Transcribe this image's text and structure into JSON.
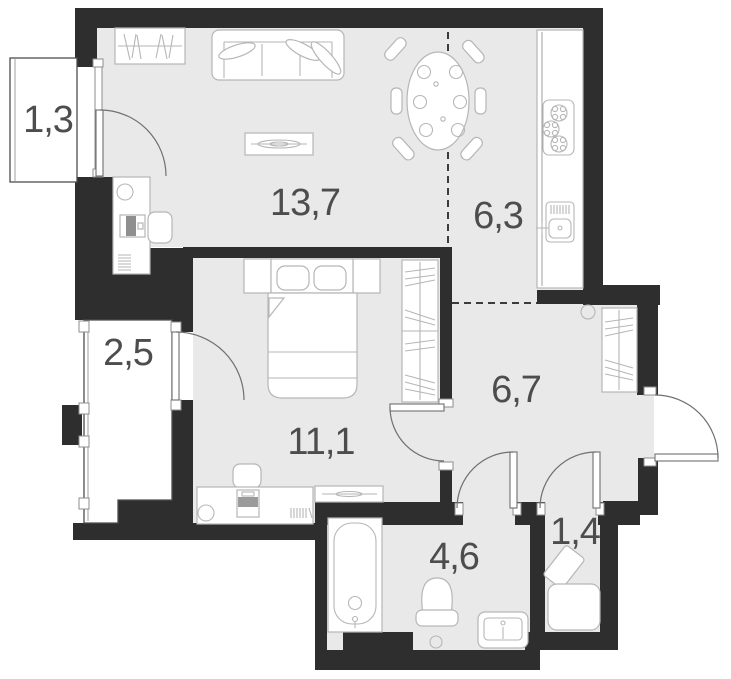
{
  "plan": {
    "type": "apartment-floor-plan",
    "colors": {
      "wall": "#2e2e2e",
      "floor": "#e9e9e9",
      "balcony_floor": "#ffffff",
      "furniture_stroke": "#b6b6b6",
      "label": "#4d4d4d",
      "door_arc": "#707070",
      "zone_dash": "#3c3c3c"
    },
    "rooms": [
      {
        "id": "balcony-top",
        "area": "1,3",
        "furniture": []
      },
      {
        "id": "living-room",
        "area": "13,7",
        "furniture": [
          "wardrobe",
          "sofa",
          "coffee-table",
          "desk",
          "chair",
          "monitor",
          "lamp",
          "radiator"
        ]
      },
      {
        "id": "kitchen",
        "area": "6,3",
        "furniture": [
          "dining-table",
          "chairs",
          "counter",
          "stove",
          "sink"
        ]
      },
      {
        "id": "balcony-left",
        "area": "2,5",
        "furniture": []
      },
      {
        "id": "bedroom",
        "area": "11,1",
        "furniture": [
          "double-bed",
          "nightstands",
          "wardrobe",
          "desk",
          "chair",
          "computer",
          "lamp",
          "dresser"
        ]
      },
      {
        "id": "hallway",
        "area": "6,7",
        "furniture": [
          "wardrobe",
          "ceiling-lamp"
        ]
      },
      {
        "id": "bathroom",
        "area": "4,6",
        "furniture": [
          "bathtub",
          "toilet",
          "washbasin",
          "floor-drain"
        ]
      },
      {
        "id": "storage",
        "area": "1,4",
        "furniture": [
          "washing-machine"
        ]
      }
    ]
  }
}
